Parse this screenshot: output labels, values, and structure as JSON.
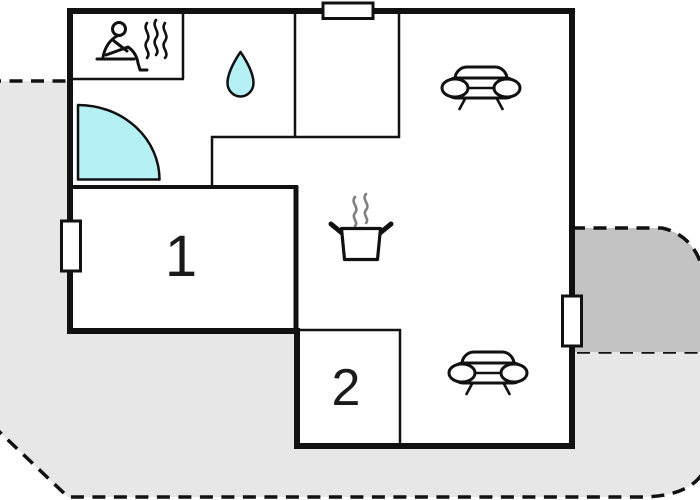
{
  "plan": {
    "room_labels": [
      "1",
      "2"
    ],
    "icons": [
      "sauna-icon",
      "water-drop-icon",
      "door-swing-icon",
      "stove-pot-icon",
      "sofa-icon",
      "sofa-icon"
    ],
    "colors": {
      "terrace_light": "#e7e7e7",
      "terrace_dark": "#c3c3c3",
      "accent_cyan": "#b5f0f4",
      "line": "#111111"
    }
  }
}
